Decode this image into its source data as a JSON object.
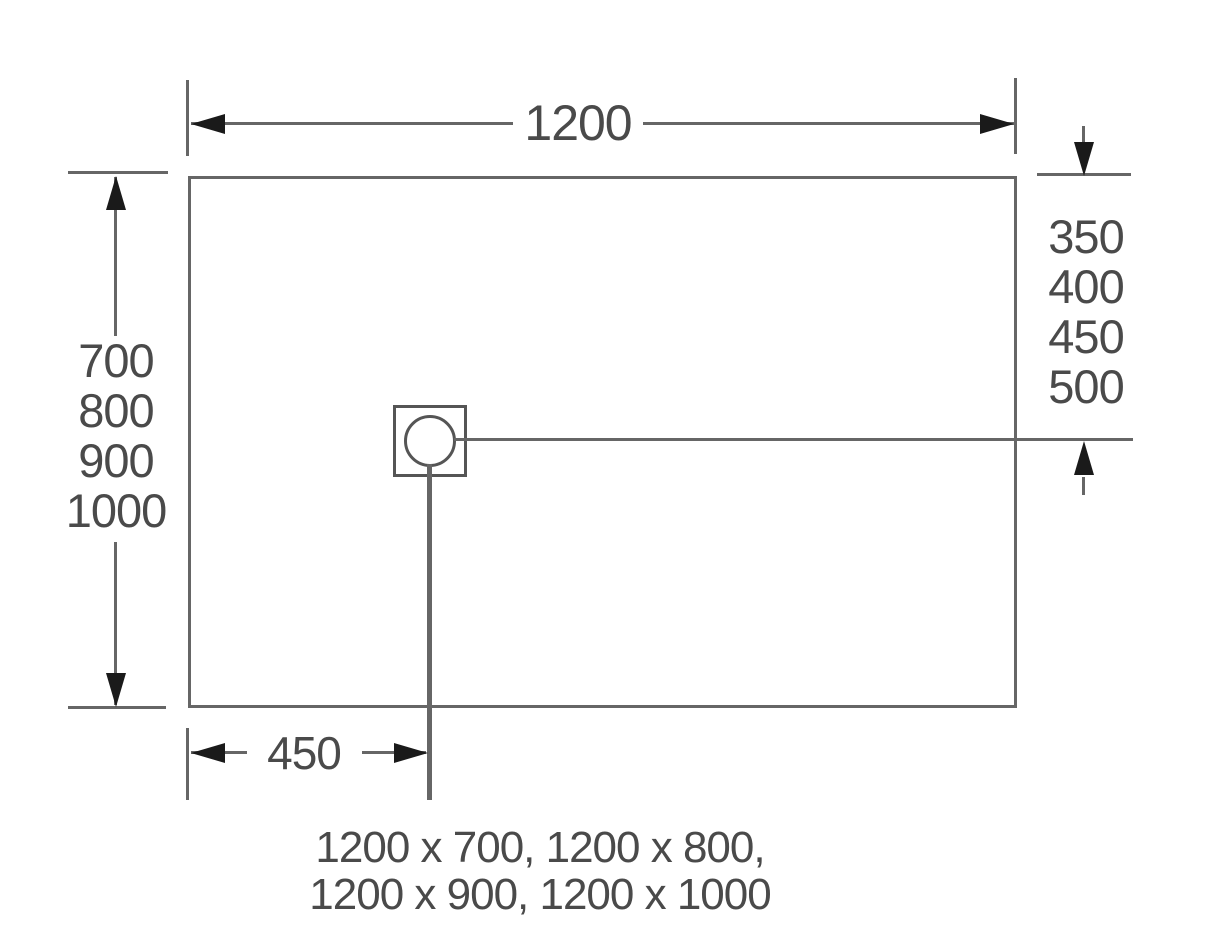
{
  "diagram": {
    "width_dim": {
      "label": "1200"
    },
    "length_dim": {
      "labels": [
        "700",
        "800",
        "900",
        "1000"
      ]
    },
    "drain_offset_from_top": {
      "labels": [
        "350",
        "400",
        "450",
        "500"
      ]
    },
    "drain_offset_from_left": {
      "label": "450"
    },
    "caption": {
      "line1": "1200 x 700, 1200 x 800,",
      "line2": "1200 x 900, 1200 x 1000"
    },
    "colors": {
      "background": "#ffffff",
      "line": "#666666",
      "drain_line": "#555555",
      "arrow": "#1a1a1a",
      "text": "#4a4a4a"
    }
  }
}
